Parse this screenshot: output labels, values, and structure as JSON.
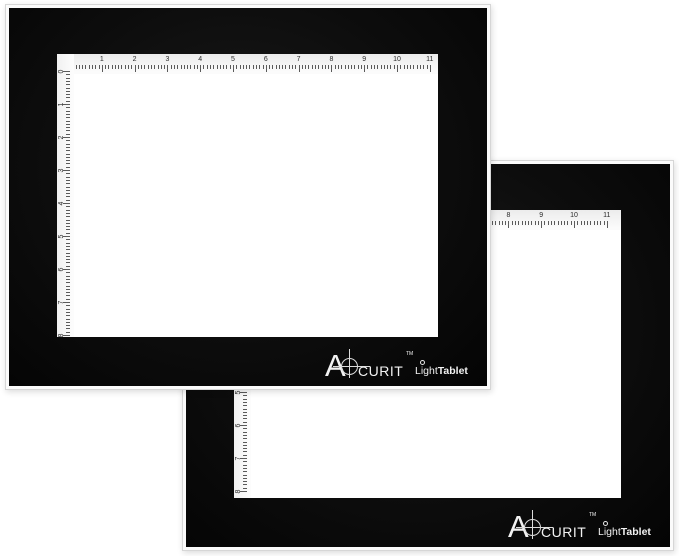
{
  "product": {
    "brand_initial": "A",
    "brand_rest": "CURIT",
    "trademark": "TM",
    "light": "Light",
    "tablet": "Tablet"
  },
  "ruler": {
    "top_numbers": [
      "0",
      "1",
      "2",
      "3",
      "4",
      "5",
      "6",
      "7",
      "8",
      "9",
      "10",
      "11"
    ],
    "left_numbers": [
      "0",
      "1",
      "2",
      "3",
      "4",
      "5",
      "6",
      "7",
      "8"
    ],
    "minor_ticks_per_unit": 10,
    "units": "inches"
  },
  "tablets": [
    {
      "name": "front light tablet"
    },
    {
      "name": "back light tablet"
    }
  ],
  "colors": {
    "background": "#ffffff",
    "frame_black": "#0d0d0d",
    "edge_white": "#fbfbfb",
    "surface_white": "#ffffff",
    "tick_gray": "#5a5a5a",
    "logo_white": "#f2f2f2"
  }
}
